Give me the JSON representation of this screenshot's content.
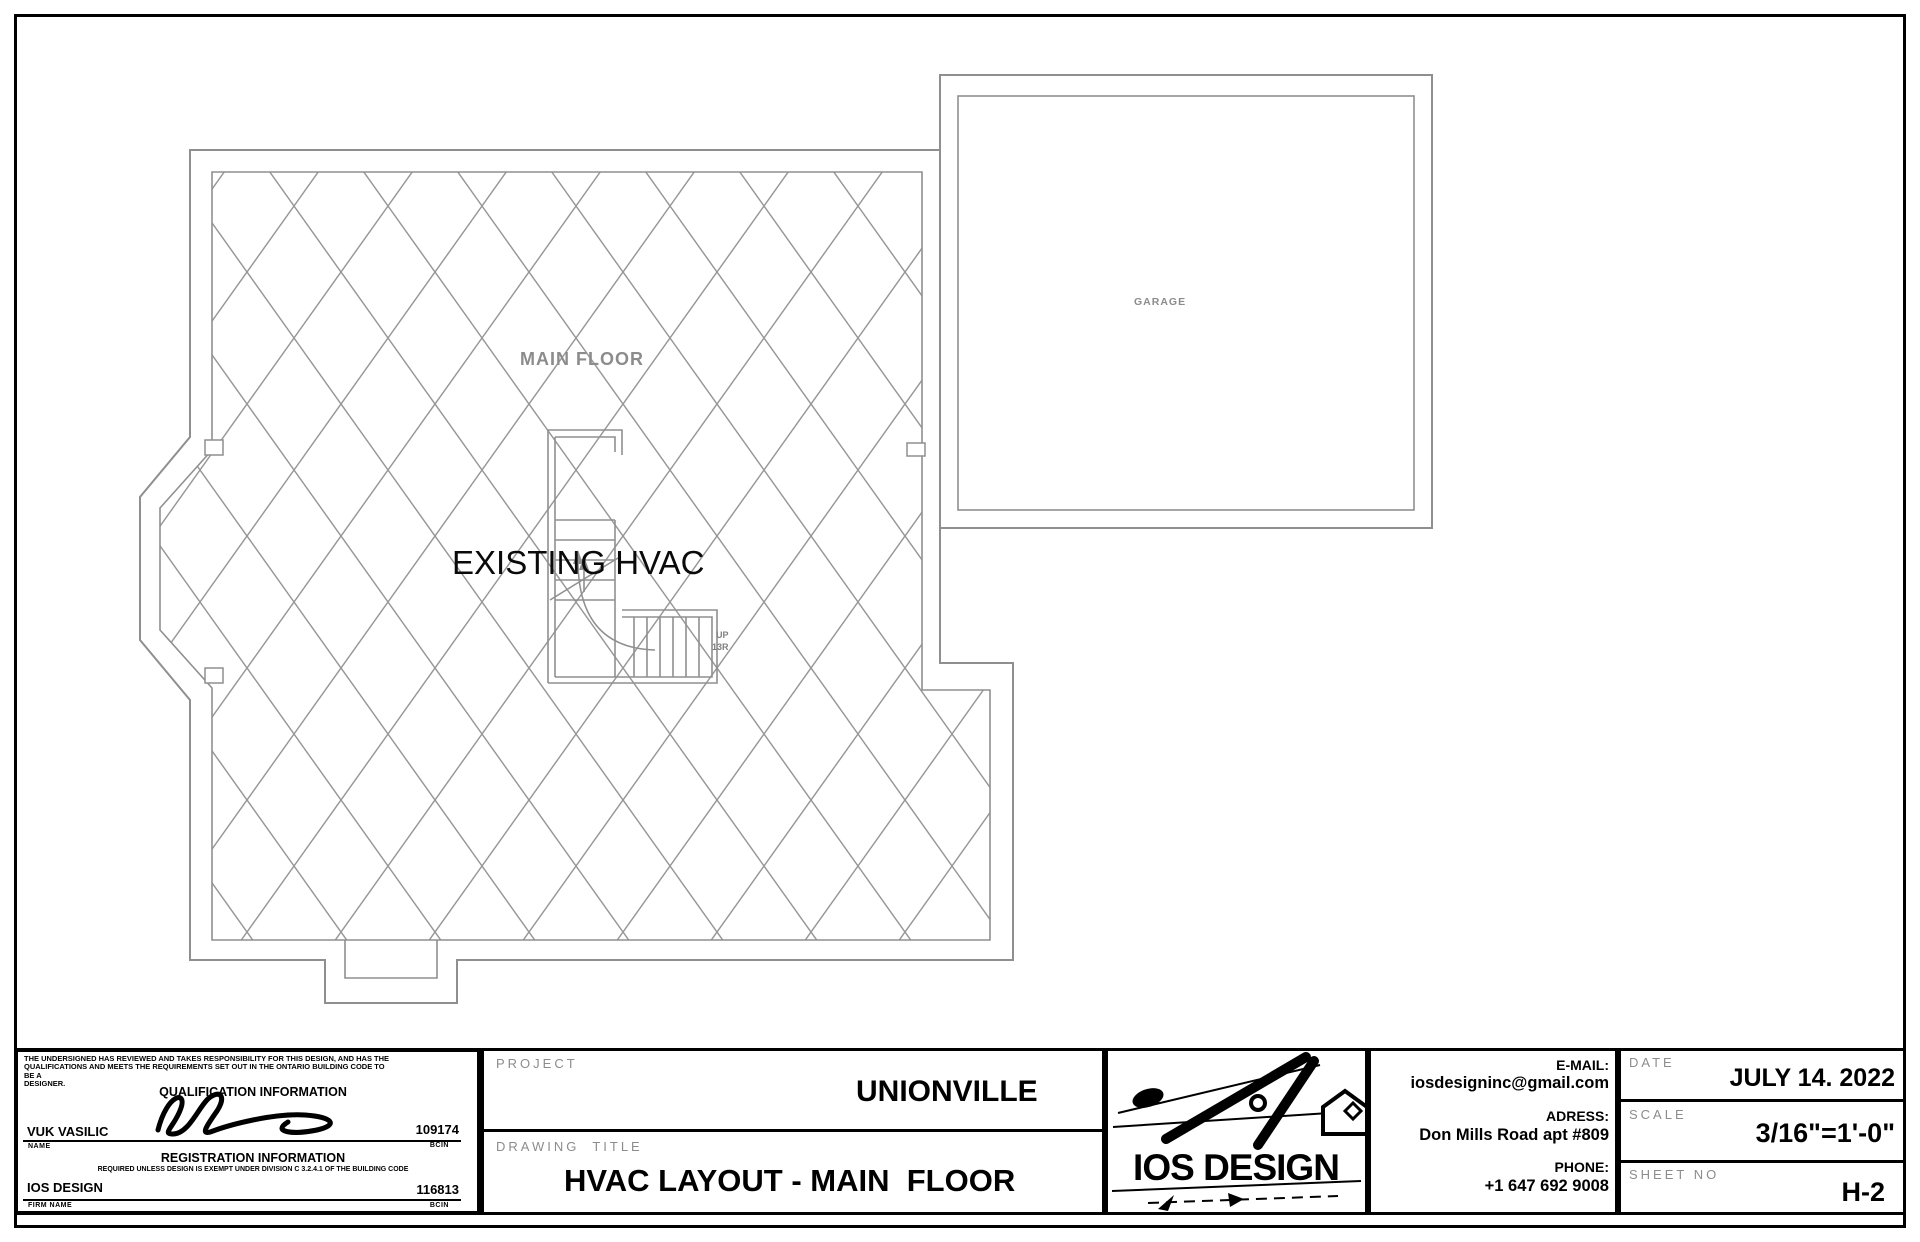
{
  "plan": {
    "main_floor_label": "MAIN FLOOR",
    "existing_hvac_label": "EXISTING HVAC",
    "garage_label": "GARAGE",
    "stair_up_label": "UP",
    "stair_risers_label": "13R"
  },
  "title_block": {
    "qualification": {
      "disclaimer_line1": "THE UNDERSIGNED HAS REVIEWED AND TAKES RESPONSIBILITY FOR THIS DESIGN, AND HAS THE",
      "disclaimer_line2": "QUALIFICATIONS AND MEETS THE REQUIREMENTS SET OUT IN THE ONTARIO BUILDING CODE TO BE A",
      "disclaimer_line3": "DESIGNER.",
      "section1_title": "QUALIFICATION INFORMATION",
      "name_value": "VUK VASILIC",
      "name_label": "NAME",
      "bcin1_value": "109174",
      "bcin_label": "BCIN",
      "section2_title": "REGISTRATION INFORMATION",
      "registration_note": "REQUIRED UNLESS DESIGN IS EXEMPT UNDER DIVISION C 3.2.4.1 OF THE BUILDING CODE",
      "firm_value": "IOS DESIGN",
      "firm_label": "FIRM NAME",
      "bcin2_value": "116813"
    },
    "project": {
      "label": "PROJECT",
      "value": "UNIONVILLE"
    },
    "drawing": {
      "label": "DRAWING  TITLE",
      "value": "HVAC LAYOUT - MAIN  FLOOR"
    },
    "logo_text": "IOS DESIGN",
    "contact": {
      "email_label": "E-MAIL:",
      "email_value": "iosdesigninc@gmail.com",
      "address_label": "ADRESS:",
      "address_value": "Don Mills Road apt #809",
      "phone_label": "PHONE:",
      "phone_value": "+1 647 692 9008"
    },
    "date": {
      "label": "DATE",
      "value": "JULY 14. 2022"
    },
    "scale": {
      "label": "SCALE",
      "value": "3/16\"=1'-0\""
    },
    "sheet": {
      "label": "SHEET NO",
      "value": "H-2"
    }
  },
  "colors": {
    "wall_gray": "#8f8f8f",
    "hatch_gray": "#979797",
    "label_gray": "#8c8c8c",
    "ink_black": "#000000"
  }
}
